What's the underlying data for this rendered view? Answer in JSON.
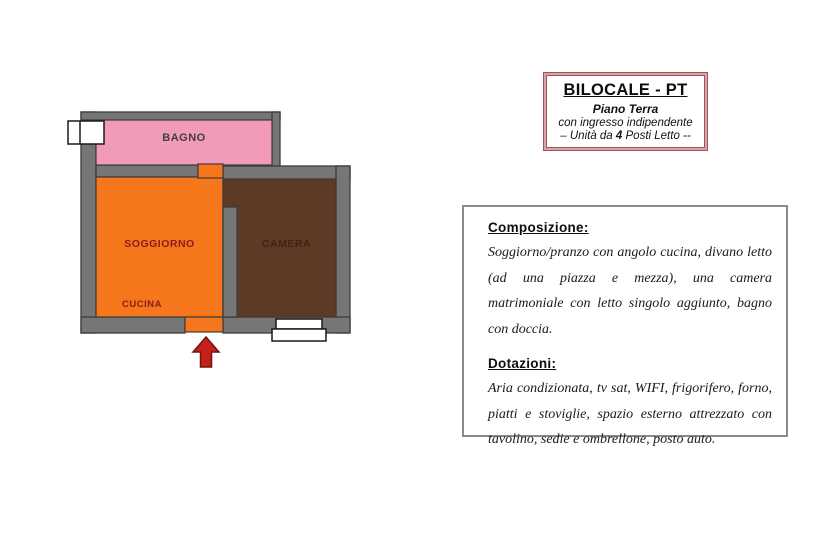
{
  "info_box": {
    "title": "BILOCALE - PT",
    "subtitle": "Piano Terra",
    "line2": "con ingresso indipendente",
    "unit_prefix": "– Unità da ",
    "unit_beds": "4",
    "unit_suffix": " Posti Letto --"
  },
  "description_box": {
    "composition_heading": "Composizione:",
    "composition_text": "Soggiorno/pranzo con angolo cucina, divano letto (ad una piazza e mezza), una camera matrimoniale con letto singolo aggiunto, bagno con doccia.",
    "features_heading": "Dotazioni:",
    "features_text": "Aria condizionata, tv sat, WIFI, frigorifero, forno, piatti e stoviglie, spazio esterno attrezzato con tavolino, sedie e ombrellone, posto auto."
  },
  "floorplan": {
    "rooms": [
      {
        "name": "bagno",
        "label": "BAGNO"
      },
      {
        "name": "soggiorno",
        "label": "SOGGIORNO"
      },
      {
        "name": "cucina",
        "label": "CUCINA"
      },
      {
        "name": "camera",
        "label": "CAMERA"
      }
    ],
    "colors": {
      "wall": "#767676",
      "bagno": "#f29ab9",
      "soggiorno": "#f5761b",
      "camera": "#5d3a25",
      "arrow": "#c5211b",
      "label_red": "#8b1b1b",
      "label_dark": "#3f3f3f"
    }
  }
}
